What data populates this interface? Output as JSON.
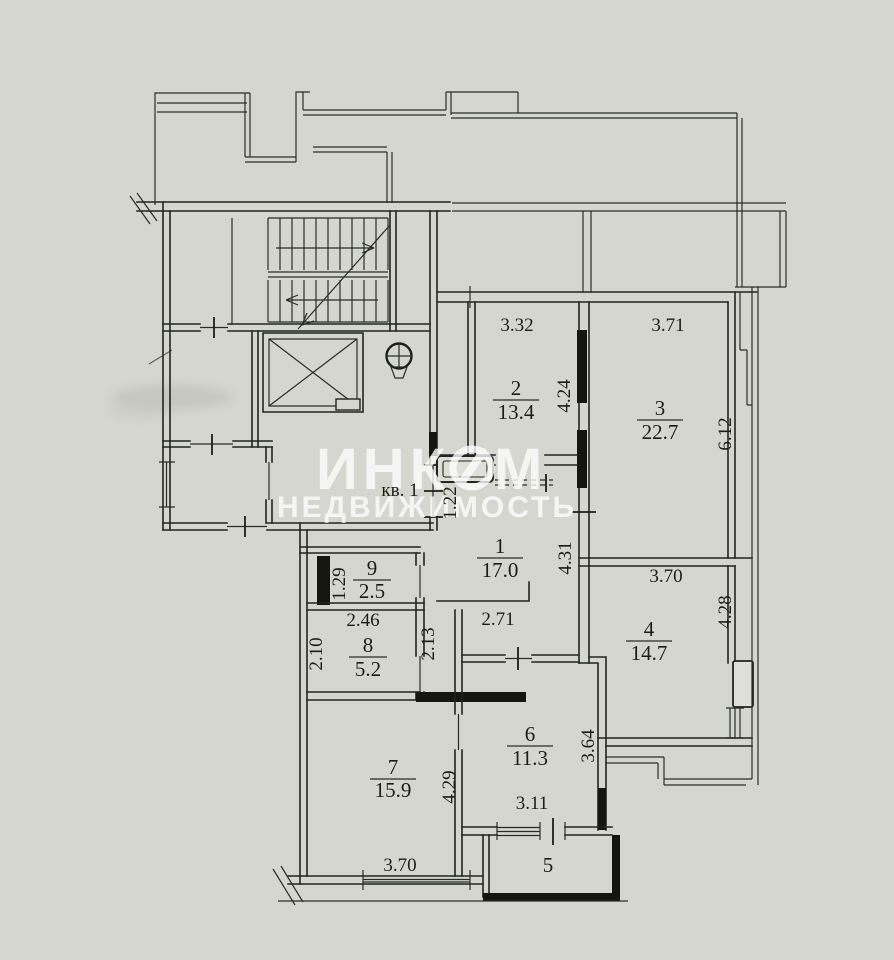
{
  "document": {
    "type": "apartment-floor-plan-scan",
    "background_color": "#d5d6d0",
    "line_color": "#222420"
  },
  "apartment_label": "кв. 1",
  "watermark": {
    "brand_left": "ИНК",
    "brand_right": "М",
    "subtitle": "НЕДВИЖИМОСТЬ",
    "color": "#ffffff"
  },
  "rooms": {
    "r1": {
      "number": "1",
      "area": "17.0"
    },
    "r2": {
      "number": "2",
      "area": "13.4"
    },
    "r3": {
      "number": "3",
      "area": "22.7"
    },
    "r4": {
      "number": "4",
      "area": "14.7"
    },
    "r5": {
      "number": "5",
      "area": ""
    },
    "r6": {
      "number": "6",
      "area": "11.3"
    },
    "r7": {
      "number": "7",
      "area": "15.9"
    },
    "r8": {
      "number": "8",
      "area": "5.2"
    },
    "r9": {
      "number": "9",
      "area": "2.5"
    }
  },
  "dimensions": {
    "room2_width": "3.32",
    "room2_depth": "4.24",
    "room3_width": "3.71",
    "room3_depth": "6.12",
    "entry_opening": "1.22",
    "hall_depth": "4.31",
    "hall_width": "2.71",
    "room9_depth": "1.29",
    "room8_width": "2.46",
    "room8_depth_left": "2.10",
    "room8_depth_right": "2.13",
    "room4_width": "3.70",
    "room4_depth": "4.28",
    "room6_width": "3.11",
    "room6_depth": "3.64",
    "room7_width": "3.70",
    "room7_depth": "4.29"
  }
}
